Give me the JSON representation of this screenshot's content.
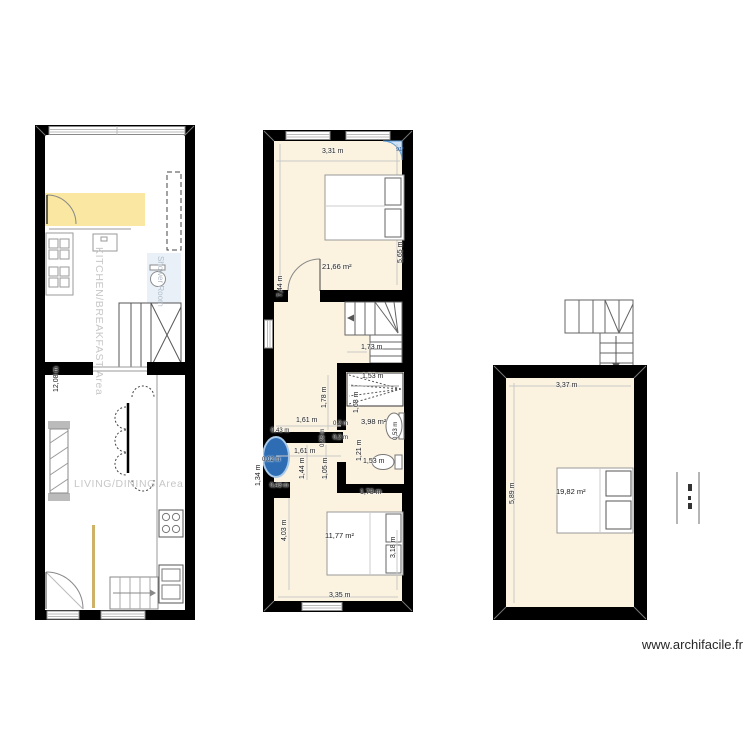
{
  "watermark": "www.archifacile.fr",
  "ground_floor": {
    "kitchen_label": "KITCHEN/BREAKFAST Area",
    "shower_label": "Shower Room",
    "living_label": "LIVING/DINING Area",
    "left_height": "12,08 m"
  },
  "first_floor": {
    "bedroom1": {
      "width": "3,31 m",
      "area": "21,66 m²",
      "height_right": "5,65 m",
      "height_left": "7,44 m",
      "corner_angle": "91°"
    },
    "landing": {
      "stair_width": "1,73 m",
      "d_178": "1,78 m",
      "d_161a": "1,61 m",
      "d_043a": "0,43 m",
      "d_02a": "0,2 m",
      "d_028": "0,28 m",
      "d_02b": "0,2 m",
      "d_161b": "1,61 m",
      "d_144": "1,44 m",
      "d_105": "1,05 m",
      "d_002": "0,02 m",
      "d_134": "1,34 m",
      "d_043b": "0,43 m"
    },
    "bathroom": {
      "area": "3,98 m²",
      "shower_width": "1,53 m",
      "height_top": "1,68 m",
      "sink_size": "0,53 m",
      "height_bottom": "1,21 m",
      "wc_width": "1,53 m"
    },
    "bedroom2": {
      "top_width": "1,73 m",
      "height_left": "4,03 m",
      "area": "11,77 m²",
      "height_right": "3,18 m",
      "bottom_width": "3,35 m"
    }
  },
  "top_floor": {
    "width": "3,37 m",
    "height_left": "5,89 m",
    "area": "19,82 m²"
  }
}
